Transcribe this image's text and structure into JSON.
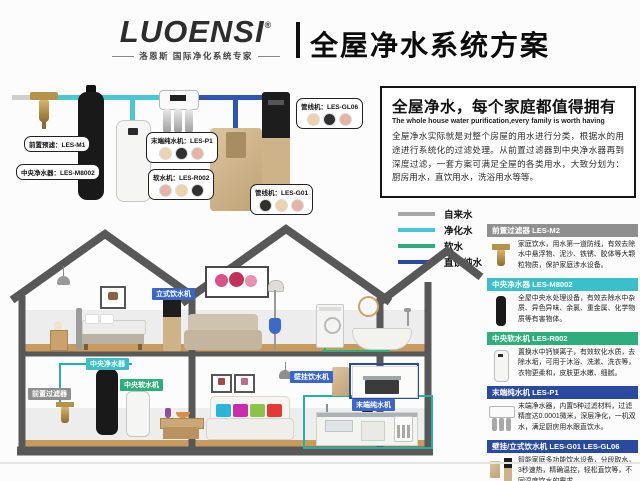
{
  "header": {
    "logo": "LUOENSI",
    "reg": "®",
    "tagline": "洛恩斯 国际净化系统专家",
    "title": "全屋净水系统方案"
  },
  "intro": {
    "title": "全屋净水，每个家庭都值得拥有",
    "subtitle": "The whole house water purification,every family is worth having",
    "body": "全屋净水实际就是对整个房屋的用水进行分类，根据水的用途进行系统化的过滤处理。从前置过滤器到中央净水器再到深度过滤，一套方案可满足全屋的各类用水，大致分划为：厨房用水，直饮用水，洗浴用水等等。"
  },
  "legend": {
    "items": [
      {
        "label": "自来水",
        "color": "#a7a7a7"
      },
      {
        "label": "净化水",
        "color": "#49c8d4"
      },
      {
        "label": "软水",
        "color": "#2fae7d"
      },
      {
        "label": "直饮纯水",
        "color": "#2a4a9f"
      }
    ]
  },
  "schematic": {
    "balloons": {
      "prefilter": "前置预滤：LES-M1",
      "central": "中央净水器：LES-M8002",
      "ro": "末端纯水机：LES-P1",
      "softener": "软水机：LES-R002",
      "pipeline_gl06": "管线机：LES-GL06",
      "pipeline_g01": "管线机：LES-G01"
    }
  },
  "products": [
    {
      "name": "前置过滤器 LES-M2",
      "color": "#8f8f8f",
      "desc": "家庭饮水，用水第一道防线，有效去除水中悬浮物、泥沙、铁锈、胶体等大颗粒物质，保护家庭涉水设备。"
    },
    {
      "name": "中央净水器 LES-M8002",
      "color": "#3bbfca",
      "desc": "全屋中央水处理设备，有效去除水中杂质、异色异味、余氯、重金属、化学物质等有害物体。"
    },
    {
      "name": "中央软水机 LES-R002",
      "color": "#2fae7d",
      "desc": "置换水中钙镁离子，有效软化水质，去除水垢，可用于沐浴、洗漱、洗衣等，衣物更柔和，皮肤更水嫩、细腻。"
    },
    {
      "name": "末端纯水机 LES-P1",
      "color": "#2a4a9f",
      "desc": "末端净水器，内置5种过滤材料，过滤精度达0.0001微米，深层净化，一机双水，满足厨房用水跟直饮水。"
    },
    {
      "name": "壁挂/立式饮水机 LES-G01 LES-GL06",
      "color": "#2a4a9f",
      "desc": "智能家庭多功能饮水设备，分段取水，3秒速热，精确温控，轻松直饮等，不同温度饮水的需求。"
    }
  ],
  "house": {
    "labels": {
      "standing": {
        "text": "立式饮水机",
        "color": "#3a66cc"
      },
      "central": {
        "text": "中央净水器",
        "color": "#3bbfca"
      },
      "softener": {
        "text": "中央软水机",
        "color": "#2fae7d"
      },
      "prefilter": {
        "text": "前置过滤器",
        "color": "#8f8f8f"
      },
      "wall": {
        "text": "壁挂饮水机",
        "color": "#3a66cc"
      },
      "ro": {
        "text": "末端纯水机",
        "color": "#3a66cc"
      }
    }
  }
}
